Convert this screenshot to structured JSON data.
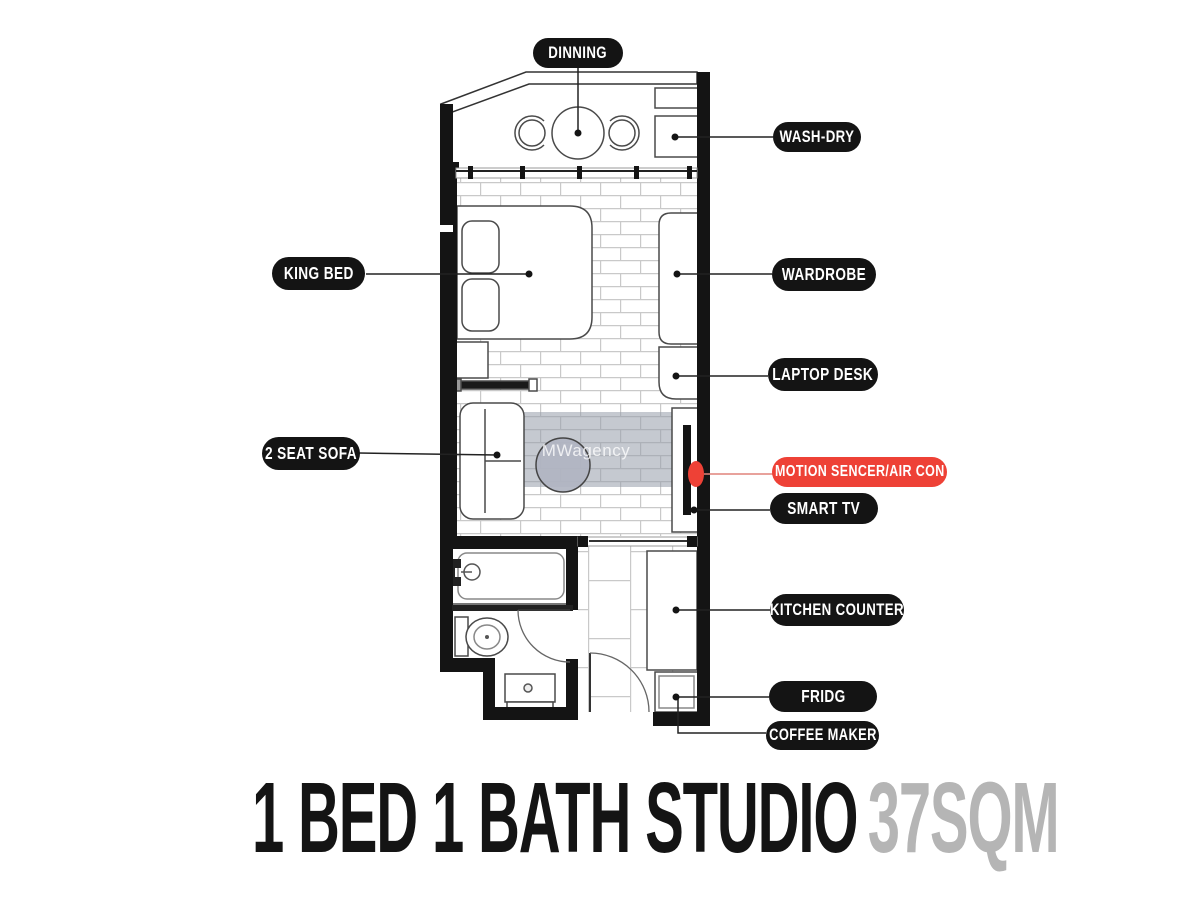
{
  "title": {
    "main": "1 BED 1 BATH STUDIO",
    "area": "37SQM"
  },
  "watermark": "MWagency",
  "labels": [
    {
      "id": "dinning",
      "text": "DINNING",
      "style": "black"
    },
    {
      "id": "wash-dry",
      "text": "WASH-DRY",
      "style": "black"
    },
    {
      "id": "king-bed",
      "text": "KING BED",
      "style": "black"
    },
    {
      "id": "wardrobe",
      "text": "WARDROBE",
      "style": "black"
    },
    {
      "id": "laptop-desk",
      "text": "LAPTOP DESK",
      "style": "black"
    },
    {
      "id": "two-seat-sofa",
      "text": "2 SEAT SOFA",
      "style": "black"
    },
    {
      "id": "motion-sencer",
      "text": "MOTION SENCER/AIR CON",
      "style": "red"
    },
    {
      "id": "smart-tv",
      "text": "SMART TV",
      "style": "black"
    },
    {
      "id": "kitchen-counter",
      "text": "KITCHEN COUNTER",
      "style": "black"
    },
    {
      "id": "fridg",
      "text": "FRIDG",
      "style": "black"
    },
    {
      "id": "coffee-maker",
      "text": "COFFEE MAKER",
      "style": "black"
    }
  ],
  "colors": {
    "pill_black": "#141414",
    "pill_red": "#ee4136",
    "pill_text": "#ffffff",
    "accent_red": "#ee4136",
    "accent_red_line": "#e0847b",
    "title_black": "#141414",
    "title_gray": "#b5b5b5",
    "wall": "#141414",
    "outline": "#4a4a4a",
    "mortar": "#c9c9c9",
    "rug": "rgba(150,156,170,0.55)"
  }
}
